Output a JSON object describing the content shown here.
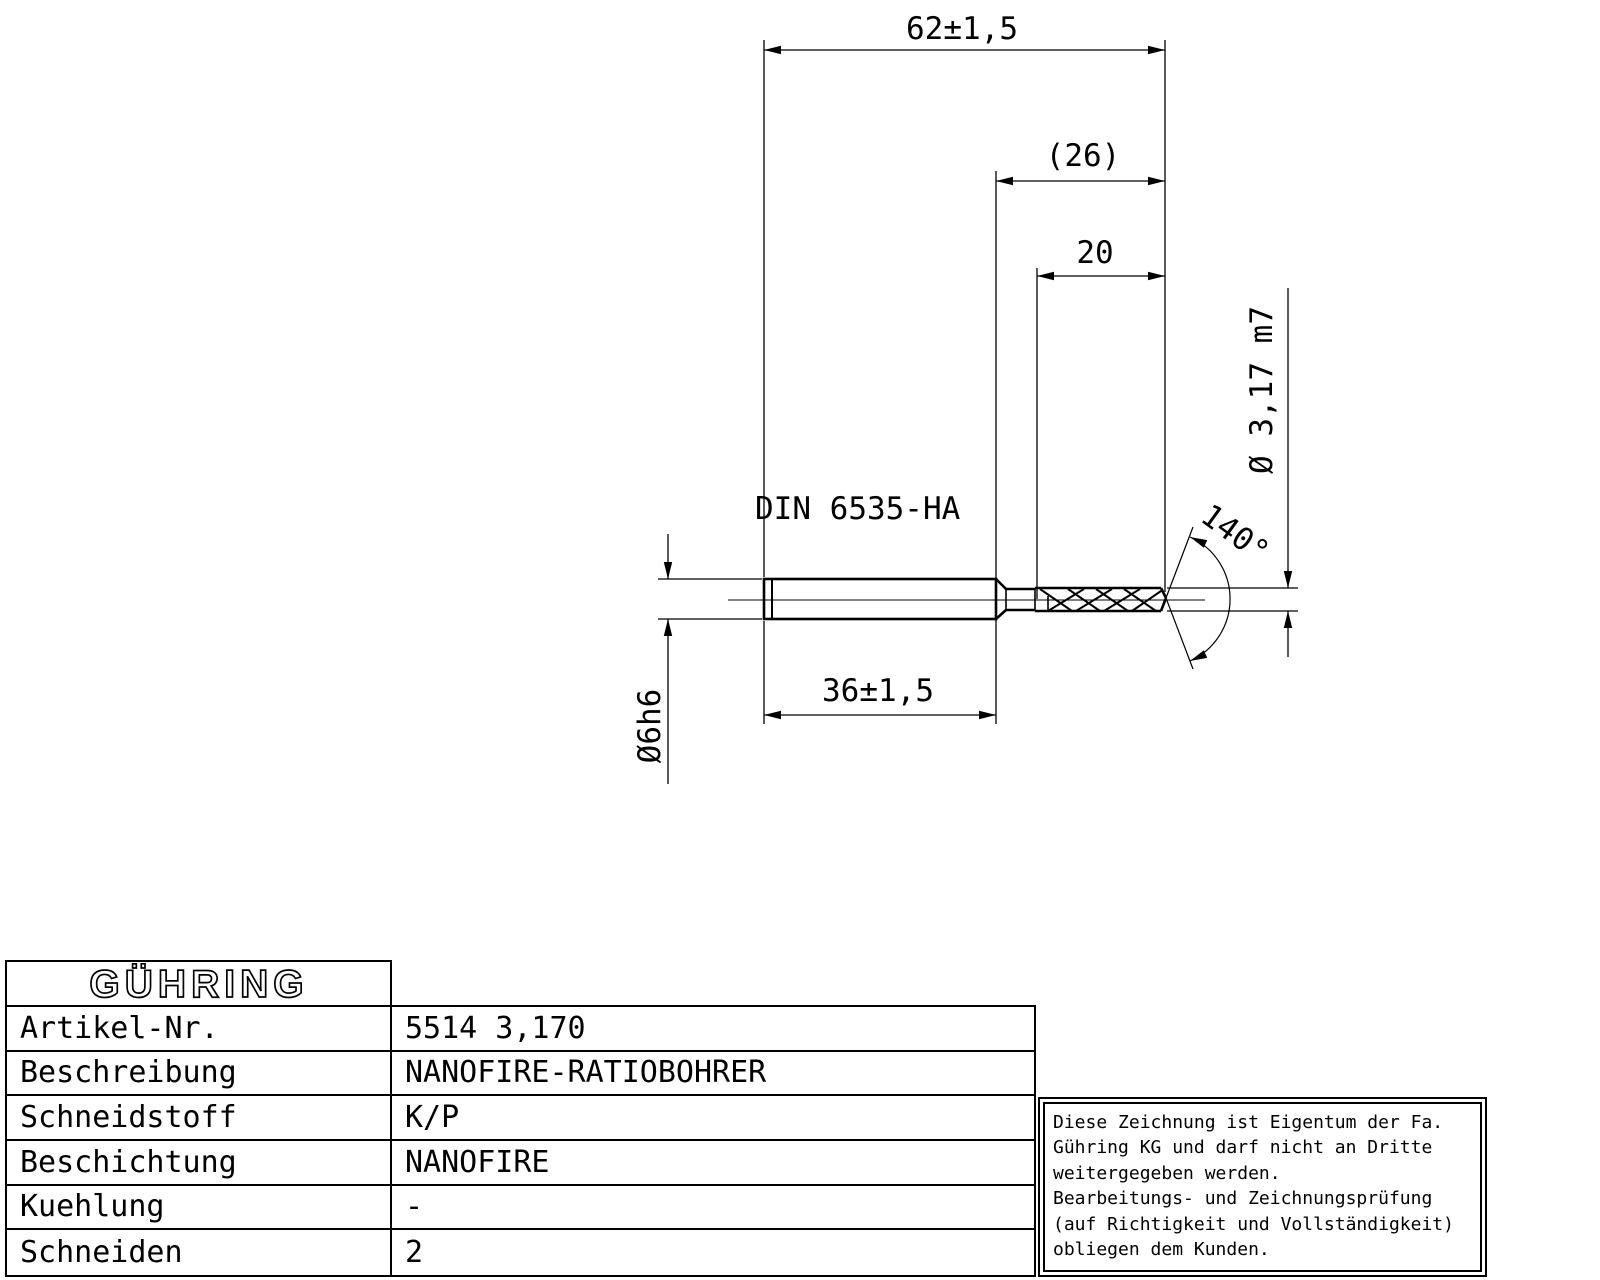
{
  "drawing": {
    "overall_length": "62±1,5",
    "flute_length_ref": "(26)",
    "flute_length": "20",
    "shank_length": "36±1,5",
    "shank_norm": "DIN 6535-HA",
    "drill_diameter": "Ø 3,17 m7",
    "shank_diameter": "Ø6h6",
    "point_angle": "140°"
  },
  "table": {
    "logo": "GÜHRING",
    "rows": [
      {
        "label": "Artikel-Nr.",
        "value": "5514 3,170"
      },
      {
        "label": "Beschreibung",
        "value": "NANOFIRE-RATIOBOHRER"
      },
      {
        "label": "Schneidstoff",
        "value": "K/P"
      },
      {
        "label": "Beschichtung",
        "value": "NANOFIRE"
      },
      {
        "label": "Kuehlung",
        "value": "-"
      },
      {
        "label": "Schneiden",
        "value": "2"
      }
    ]
  },
  "notice": {
    "lines": [
      "Diese Zeichnung ist Eigentum der Fa.",
      "Gühring KG und darf nicht an Dritte",
      "weitergegeben werden.",
      "Bearbeitungs- und Zeichnungsprüfung",
      "(auf Richtigkeit und Vollständigkeit)",
      "obliegen dem Kunden."
    ]
  },
  "colors": {
    "line": "#000000",
    "background": "#ffffff"
  }
}
